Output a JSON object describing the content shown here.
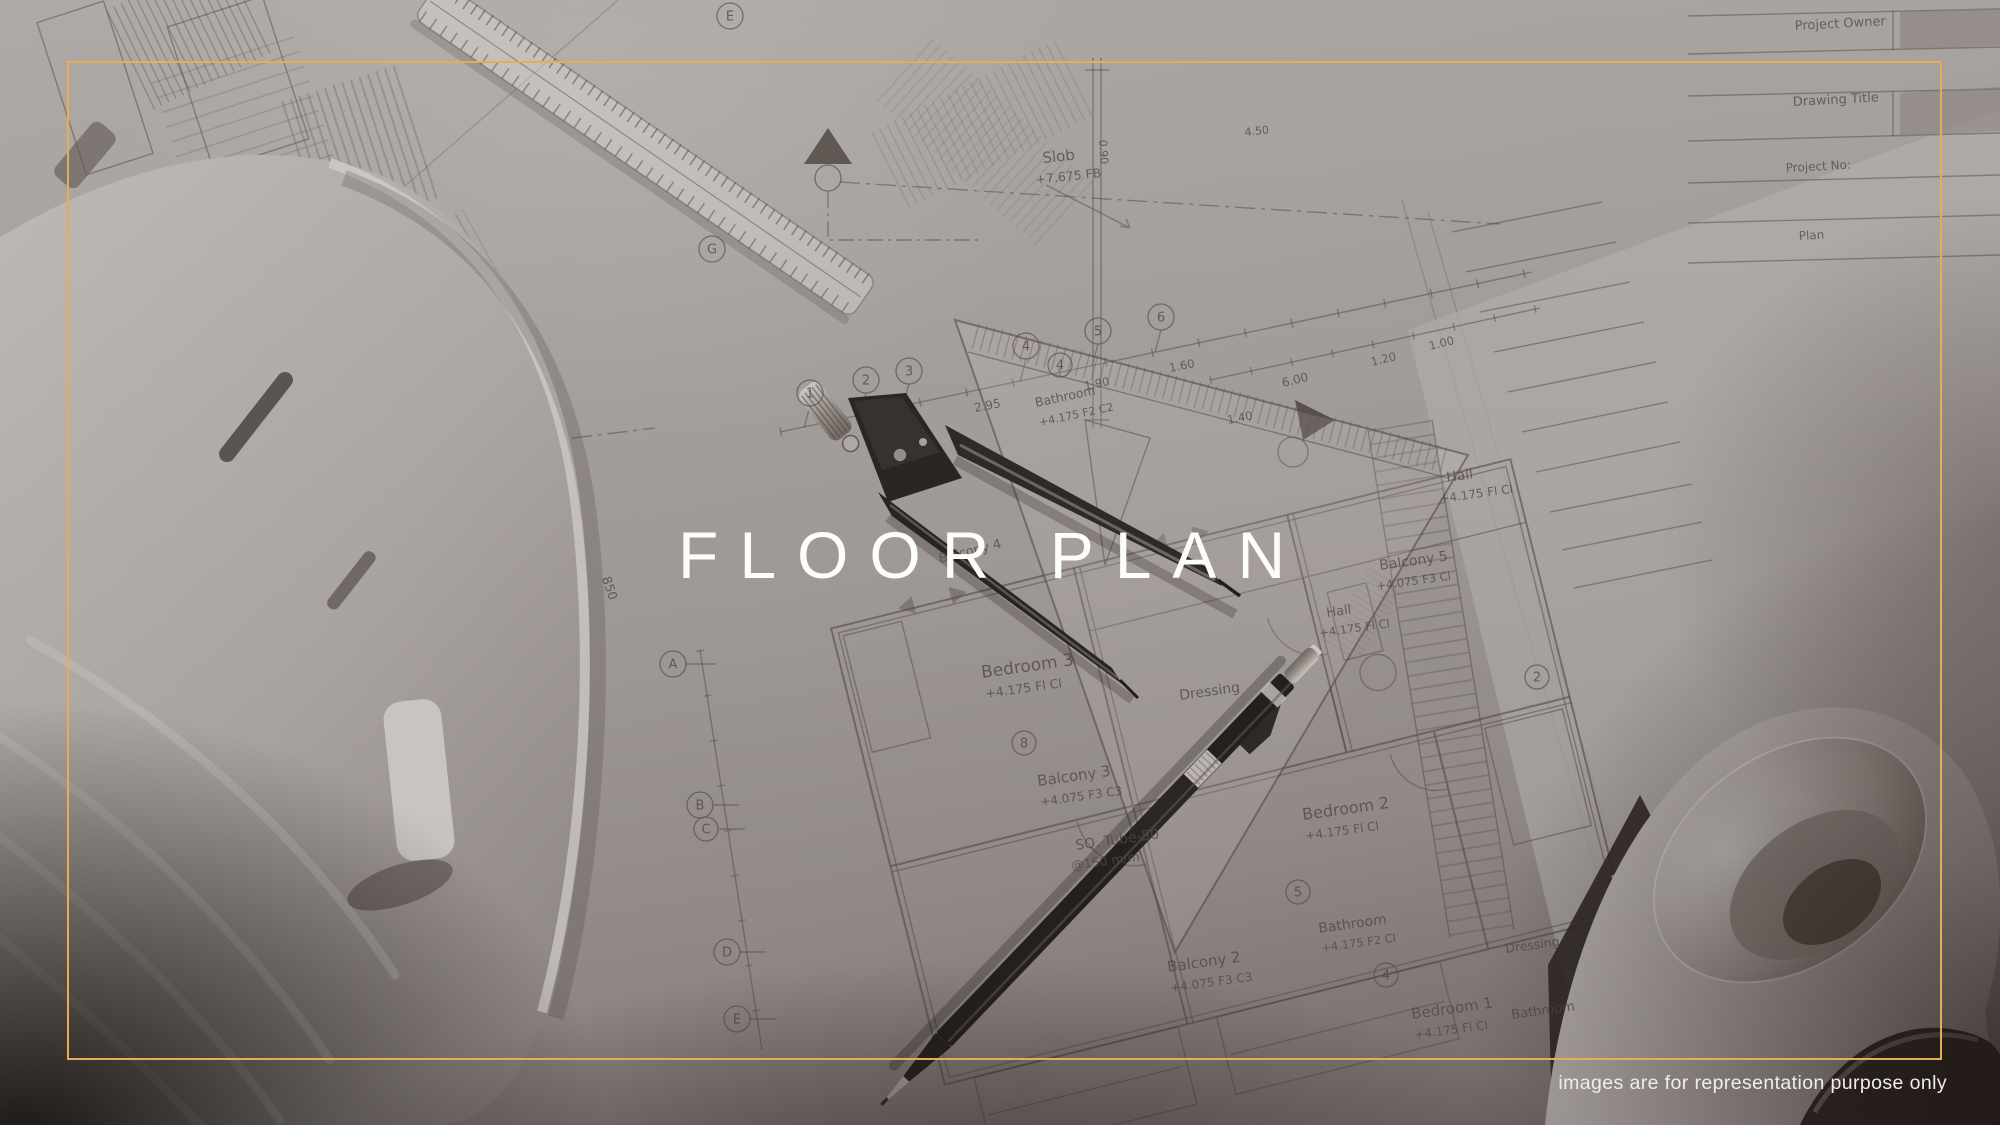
{
  "page": {
    "title": "FLOOR PLAN",
    "disclaimer": "images are for representation purpose only"
  },
  "colors": {
    "frame_gold": "#E3AE55",
    "title_white": "#FDFDFC"
  },
  "photo": {
    "objects": [
      "hard-hat",
      "scale-ruler",
      "set-square",
      "drafting-compass",
      "mechanical-pencil",
      "blueprint-sheets",
      "blueprint-rolls"
    ]
  },
  "blueprint": {
    "labels": [
      {
        "t": "Bedroom 3"
      },
      {
        "t": "+4.175  Fl  Cl"
      },
      {
        "t": "Dressing"
      },
      {
        "t": "Balcony 3"
      },
      {
        "t": "+4.075  F3  C3"
      },
      {
        "t": "Bedroom 2"
      },
      {
        "t": "+4.175  Fl  Cl"
      },
      {
        "t": "Balcony 2"
      },
      {
        "t": "+4.075  F3  C3"
      },
      {
        "t": "Bathroom"
      },
      {
        "t": "+4.175  F2  Cl"
      },
      {
        "t": "Hall"
      },
      {
        "t": "+4.175  Fl  Cl"
      },
      {
        "t": "Bedroom 1"
      },
      {
        "t": "+4.175  Fl  Cl"
      },
      {
        "t": "Dressing"
      },
      {
        "t": "Balcony 5"
      },
      {
        "t": "+4.075  F3  Cl"
      },
      {
        "t": "Balcony 4"
      },
      {
        "t": "Slob"
      },
      {
        "t": "+7.675  FB"
      },
      {
        "t": "SQ. Tube-50"
      },
      {
        "t": "@150 m/m"
      },
      {
        "t": "850"
      },
      {
        "t": "Project Owner"
      },
      {
        "t": "Drawing Title"
      },
      {
        "t": "Project No:"
      },
      {
        "t": "Plan"
      },
      {
        "t": "Bathroom"
      },
      {
        "t": "2.95"
      },
      {
        "t": "1.90"
      },
      {
        "t": "1.60"
      },
      {
        "t": "1.40"
      },
      {
        "t": "6.00"
      },
      {
        "t": "1.20"
      },
      {
        "t": "1.00"
      },
      {
        "t": "Hall"
      },
      {
        "t": "+4.175  Fl  Cl"
      },
      {
        "t": "Bathroom"
      },
      {
        "t": "+4.175  F2  C2"
      },
      {
        "t": "0.90"
      },
      {
        "t": "4.50"
      }
    ],
    "bubbles": [
      {
        "t": "1"
      },
      {
        "t": "2"
      },
      {
        "t": "3"
      },
      {
        "t": "4"
      },
      {
        "t": "5"
      },
      {
        "t": "6"
      },
      {
        "t": "A"
      },
      {
        "t": "B"
      },
      {
        "t": "C"
      },
      {
        "t": "D"
      },
      {
        "t": "E"
      },
      {
        "t": "E"
      },
      {
        "t": "G"
      },
      {
        "t": "8"
      },
      {
        "t": "5"
      },
      {
        "t": "4"
      },
      {
        "t": "4"
      },
      {
        "t": "2"
      }
    ]
  }
}
